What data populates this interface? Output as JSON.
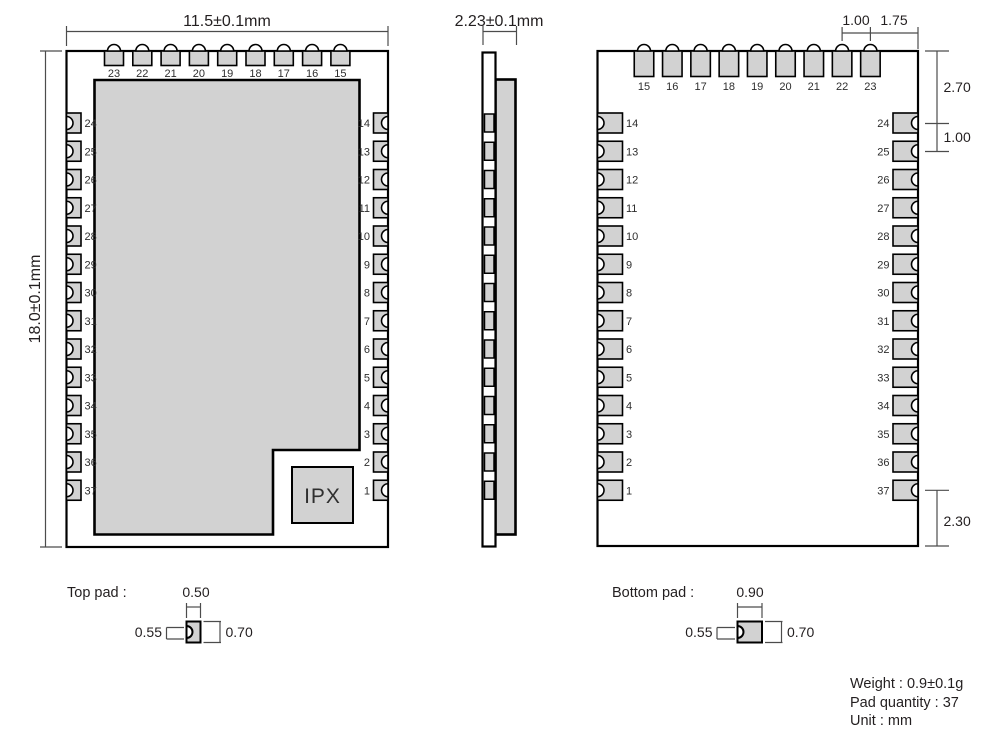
{
  "views": {
    "top": {
      "width_dim": "11.5±0.1mm",
      "height_dim": "18.0±0.1mm",
      "ipx_label": "IPX",
      "pins_top": [
        "23",
        "22",
        "21",
        "20",
        "19",
        "18",
        "17",
        "16",
        "15"
      ],
      "pins_left": [
        "24",
        "25",
        "26",
        "27",
        "28",
        "29",
        "30",
        "31",
        "32",
        "33",
        "34",
        "35",
        "36",
        "37"
      ],
      "pins_right": [
        "14",
        "13",
        "12",
        "11",
        "10",
        "9",
        "8",
        "7",
        "6",
        "5",
        "4",
        "3",
        "2",
        "1"
      ]
    },
    "side": {
      "width_dim": "2.23±0.1mm",
      "pad_count": 14
    },
    "bottom": {
      "pins_top": [
        "15",
        "16",
        "17",
        "18",
        "19",
        "20",
        "21",
        "22",
        "23"
      ],
      "pins_left": [
        "14",
        "13",
        "12",
        "11",
        "10",
        "9",
        "8",
        "7",
        "6",
        "5",
        "4",
        "3",
        "2",
        "1"
      ],
      "pins_right": [
        "24",
        "25",
        "26",
        "27",
        "28",
        "29",
        "30",
        "31",
        "32",
        "33",
        "34",
        "35",
        "36",
        "37"
      ],
      "dims": {
        "top_pin_pitch": "1.00",
        "pin_to_edge": "1.75",
        "top_edge_to_first_pin": "2.70",
        "side_pin_pitch": "1.00",
        "last_pin_to_bottom": "2.30"
      }
    }
  },
  "details": {
    "top_pad": {
      "label": "Top pad :",
      "width": "0.50",
      "left_height": "0.55",
      "right_height": "0.70"
    },
    "bottom_pad": {
      "label": "Bottom pad :",
      "width": "0.90",
      "left_height": "0.55",
      "right_height": "0.70"
    }
  },
  "info": {
    "weight": "Weight : 0.9±0.1g",
    "pad_quantity": "Pad quantity : 37",
    "unit": "Unit : mm"
  },
  "colors": {
    "pad_fill": "#d2d2d2",
    "outline": "#000000",
    "dim_line": "#4c4c4c",
    "text": "#231f20"
  }
}
